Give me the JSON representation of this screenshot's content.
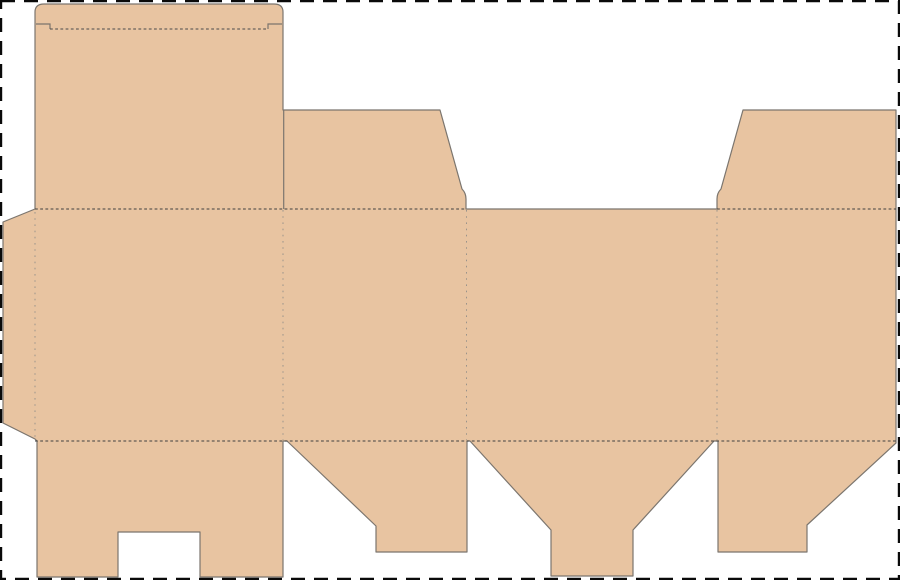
{
  "canvas": {
    "width": 900,
    "height": 580,
    "background": "#ffffff"
  },
  "trim_border": {
    "name": "trim-border",
    "color": "#0a0a0a",
    "stroke_width": 2.4,
    "dash": "14 9",
    "x": 1,
    "y": 1,
    "w": 898,
    "h": 578
  },
  "dieline": {
    "fill": "#e8c4a1",
    "cut_color": "#7b756e",
    "cut_width": 1.2,
    "silhouette": {
      "name": "carton-dieline-shape",
      "d": "M 35 209 L 35 12 Q 35 4 44 4 L 274 4 Q 283 4 283 12 L 283 110 L 440 110 L 462 189 Q 466 193 466 199 L 466 209 L 717 209 L 717 199 Q 717 193 721 189 L 743 110 L 896 110 L 896 443 L 807 525 L 807 552 L 718 552 L 718 441 L 714 441 L 633 530 L 633 576 L 551 576 L 551 530 L 470 441 L 467 441 L 467 552 L 376 552 L 376 526 L 287 441 L 283 441 L 283 577 L 200 577 L 200 532 L 118 532 L 118 577 L 37 577 L 37 441 L 35 439 L 3 423 L 3 222 Z"
    },
    "interior_cuts": [
      {
        "name": "flap-separation-cut",
        "d": "M 283.7 110 L 283.7 209"
      },
      {
        "name": "tuck-shoulder-slit-left",
        "d": "M 36 24 L 50 24 L 50 29"
      },
      {
        "name": "tuck-shoulder-slit-right",
        "d": "M 282 24 L 268 24 L 268 29"
      }
    ],
    "fold_lines": [
      {
        "name": "tuck-flap-fold",
        "d": "M 50 29 L 268 29",
        "dash": "2.8 2.4",
        "color": "#4a4a4a",
        "width": 1
      },
      {
        "name": "top-fold-left",
        "d": "M 35 209 L 466 209",
        "dash": "2.8 2.4",
        "color": "#3f3f3f",
        "width": 1
      },
      {
        "name": "top-fold-right",
        "d": "M 717 209 L 896 209",
        "dash": "2.8 2.4",
        "color": "#3f3f3f",
        "width": 1
      },
      {
        "name": "bottom-fold",
        "d": "M 35 441 L 896 441",
        "dash": "2.8 2.4",
        "color": "#3f3f3f",
        "width": 1
      },
      {
        "name": "glue-tab-fold",
        "d": "M 35 212 L 35 438",
        "dash": "1.6 4.6",
        "color": "#9a938b",
        "width": 1
      },
      {
        "name": "panel-fold-1",
        "d": "M 283 210 L 283 440",
        "dash": "1.6 4.6",
        "color": "#9a938b",
        "width": 1
      },
      {
        "name": "panel-fold-2",
        "d": "M 466.5 210 L 466.5 440",
        "dash": "1.6 4.6",
        "color": "#9a938b",
        "width": 1
      },
      {
        "name": "panel-fold-3",
        "d": "M 717 210 L 717 440",
        "dash": "1.6 4.6",
        "color": "#9a938b",
        "width": 1
      }
    ]
  }
}
